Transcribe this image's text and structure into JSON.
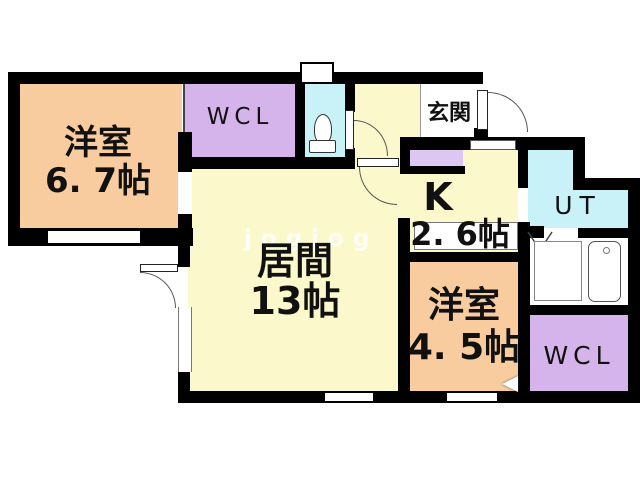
{
  "floorplan": {
    "watermark": "jogjog",
    "rooms": {
      "bedroom1": {
        "name": "洋室",
        "area": "6. 7帖"
      },
      "wcl_top": {
        "name": "WCL"
      },
      "entrance": {
        "name": "玄関"
      },
      "kitchen": {
        "name": "K",
        "area": "2. 6帖"
      },
      "utility": {
        "name": "UT"
      },
      "living": {
        "name": "居間",
        "area": "13帖"
      },
      "bedroom2": {
        "name": "洋室",
        "area": "4. 5帖"
      },
      "wcl_bottom": {
        "name": "WCL"
      }
    },
    "colors": {
      "wall": "#000000",
      "outline": "#444444",
      "bedroom": "#F8CC9E",
      "living": "#FBF8CB",
      "closet": "#D5B4EB",
      "cabinet": "#DCC6F2",
      "wet": "#C9F1F8"
    }
  }
}
